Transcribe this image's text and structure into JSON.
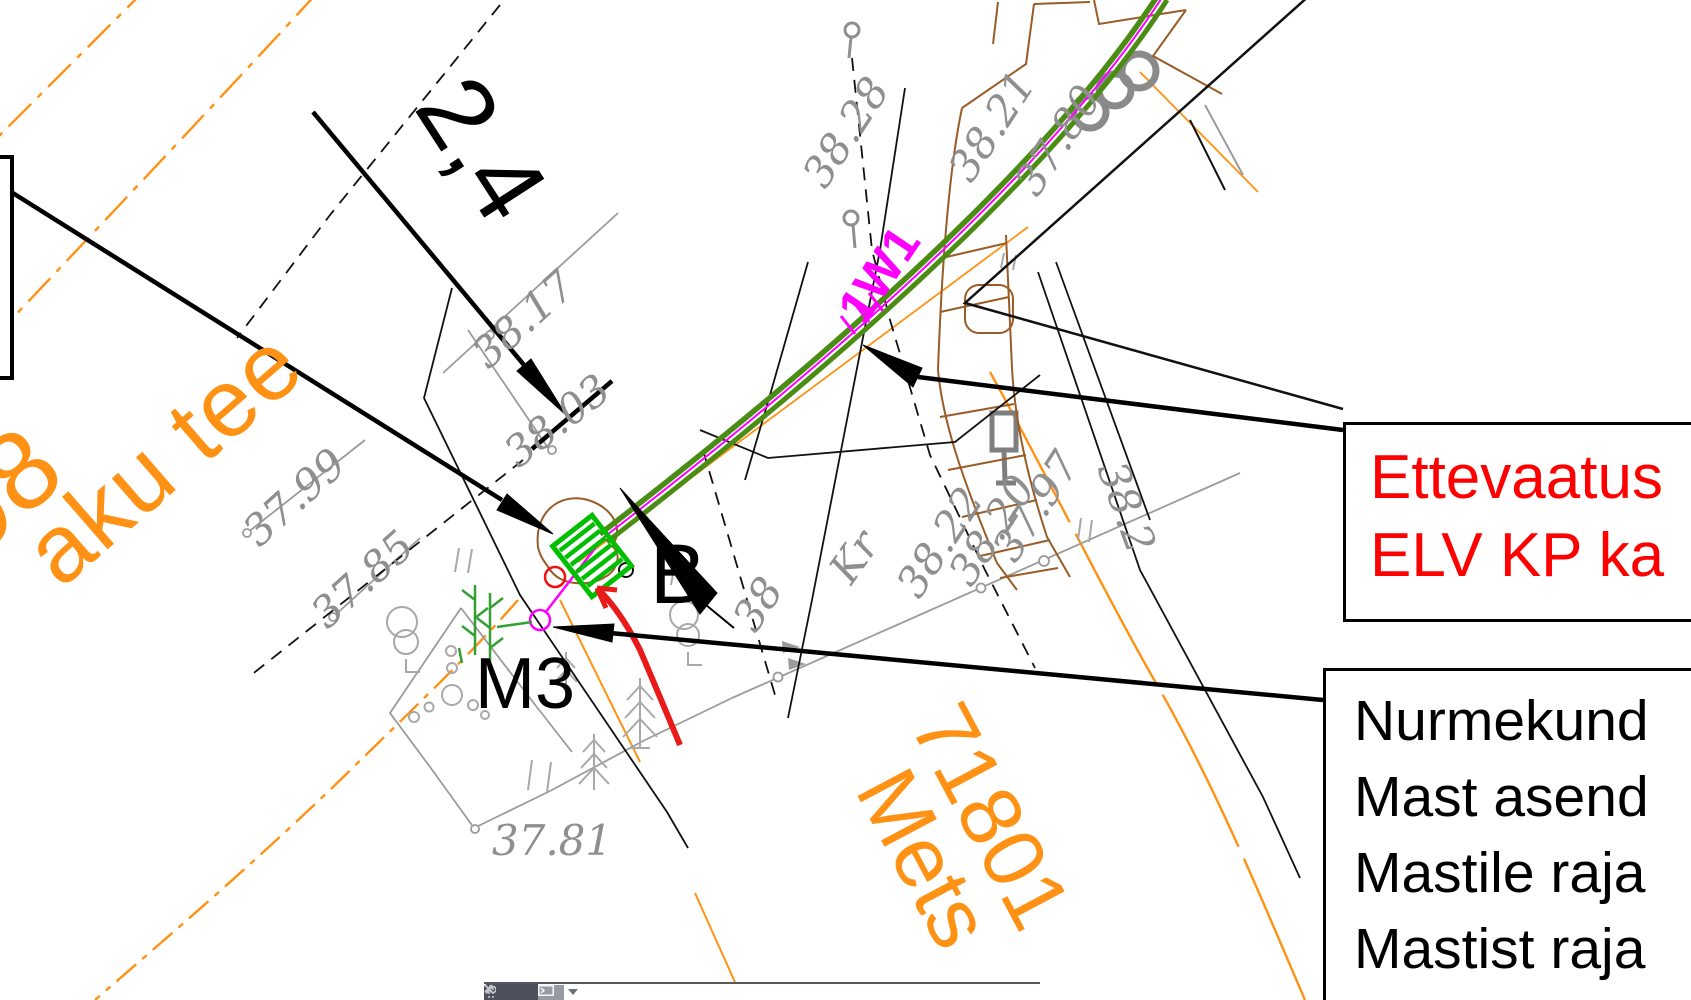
{
  "app": {
    "kind": "cad-drawing-viewport"
  },
  "colors": {
    "road_orange": "#ff9214",
    "cable_green": "#4a8c14",
    "mast_green": "#00be00",
    "veg_green": "#33a033",
    "magenta": "#ff00ff",
    "warning_red": "#ff0000",
    "sketch_red": "#e81a1a",
    "survey_gray": "#8f8f8f",
    "parcel_brown": "#995c26",
    "cmdbar_dark": "#4d4f5a"
  },
  "labels": {
    "e1": {
      "text": "38.17"
    },
    "e2": {
      "text": "38.03"
    },
    "e3": {
      "text": "37.99"
    },
    "e4": {
      "text": "37.85"
    },
    "e5": {
      "text": "37.81"
    },
    "e6": {
      "text": "38.28"
    },
    "e7": {
      "text": "38.21"
    },
    "e8": {
      "text": "37.80"
    },
    "e9": {
      "text": "38.22"
    },
    "e10": {
      "text": "38.20"
    },
    "e11": {
      "text": "37.97"
    },
    "e12": {
      "text": "38"
    },
    "e13": {
      "text": "38.2"
    },
    "kr": {
      "text": "Kr"
    },
    "street": {
      "text": "aku tee"
    },
    "street_no": {
      "text": "98"
    },
    "parcel_no": {
      "text": "71801"
    },
    "parcel_name": {
      "text": "Mets"
    },
    "dimension": {
      "text": "2,4"
    },
    "point_b": {
      "text": "B"
    },
    "mast": {
      "text": "M3"
    },
    "cable_tag": {
      "text": "1W1"
    }
  },
  "callouts": {
    "warning": {
      "line1": "Ettevaatus",
      "line2": "ELV KP ka"
    },
    "info": {
      "line1": "Nurmekund",
      "line2": "Mast asend",
      "line3": "Mastile raja",
      "line4": "Mastist raja"
    }
  },
  "toolbar": {
    "close_label": "✕",
    "icons": [
      "drag-grip",
      "close",
      "customize-wrench",
      "command-prompt",
      "recent-commands-dropdown"
    ]
  }
}
